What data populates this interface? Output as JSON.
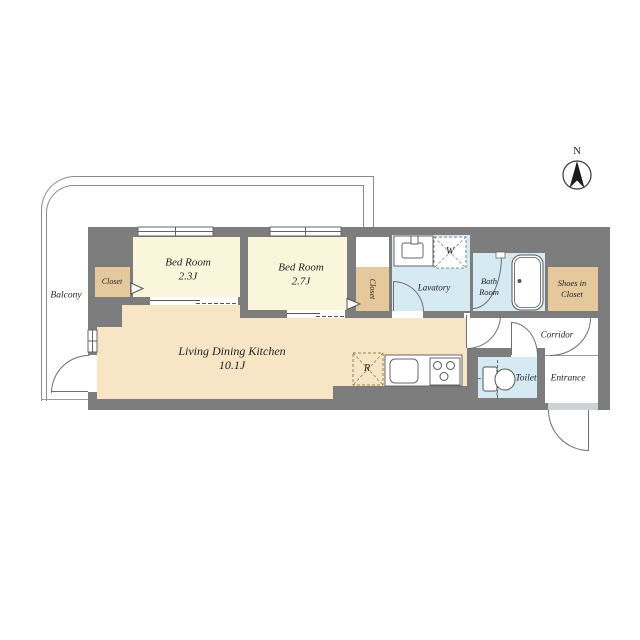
{
  "compass": {
    "north": "N"
  },
  "rooms": {
    "balcony": {
      "label": "Balcony"
    },
    "bedroom1": {
      "name": "Bed Room",
      "size": "2.3J"
    },
    "bedroom2": {
      "name": "Bed Room",
      "size": "2.7J"
    },
    "living": {
      "name": "Living Dining Kitchen",
      "size": "10.1J"
    },
    "closet1": {
      "label": "Closet"
    },
    "closet2": {
      "label": "Closet"
    },
    "lavatory": {
      "label": "Lavatory"
    },
    "bathroom": {
      "line1": "Bath",
      "line2": "Room"
    },
    "shoes_closet": {
      "line1": "Shoes in",
      "line2": "Closet"
    },
    "corridor": {
      "label": "Corridor"
    },
    "toilet": {
      "label": "Toilet"
    },
    "entrance": {
      "label": "Entrance"
    }
  },
  "fixtures": {
    "washing_machine": "W",
    "refrigerator": "R"
  },
  "colors": {
    "wall": "#7d7d7d",
    "bedroom_floor": "#faf6dc",
    "ldk_floor": "#f8e5c6",
    "closet_fill": "#e5c99c",
    "water_floor": "#d5eaf3",
    "sill": "#ccd2d6",
    "line": "#6e6e6e",
    "balcony_line": "#8a8a8a",
    "text": "#1f1f1f"
  }
}
